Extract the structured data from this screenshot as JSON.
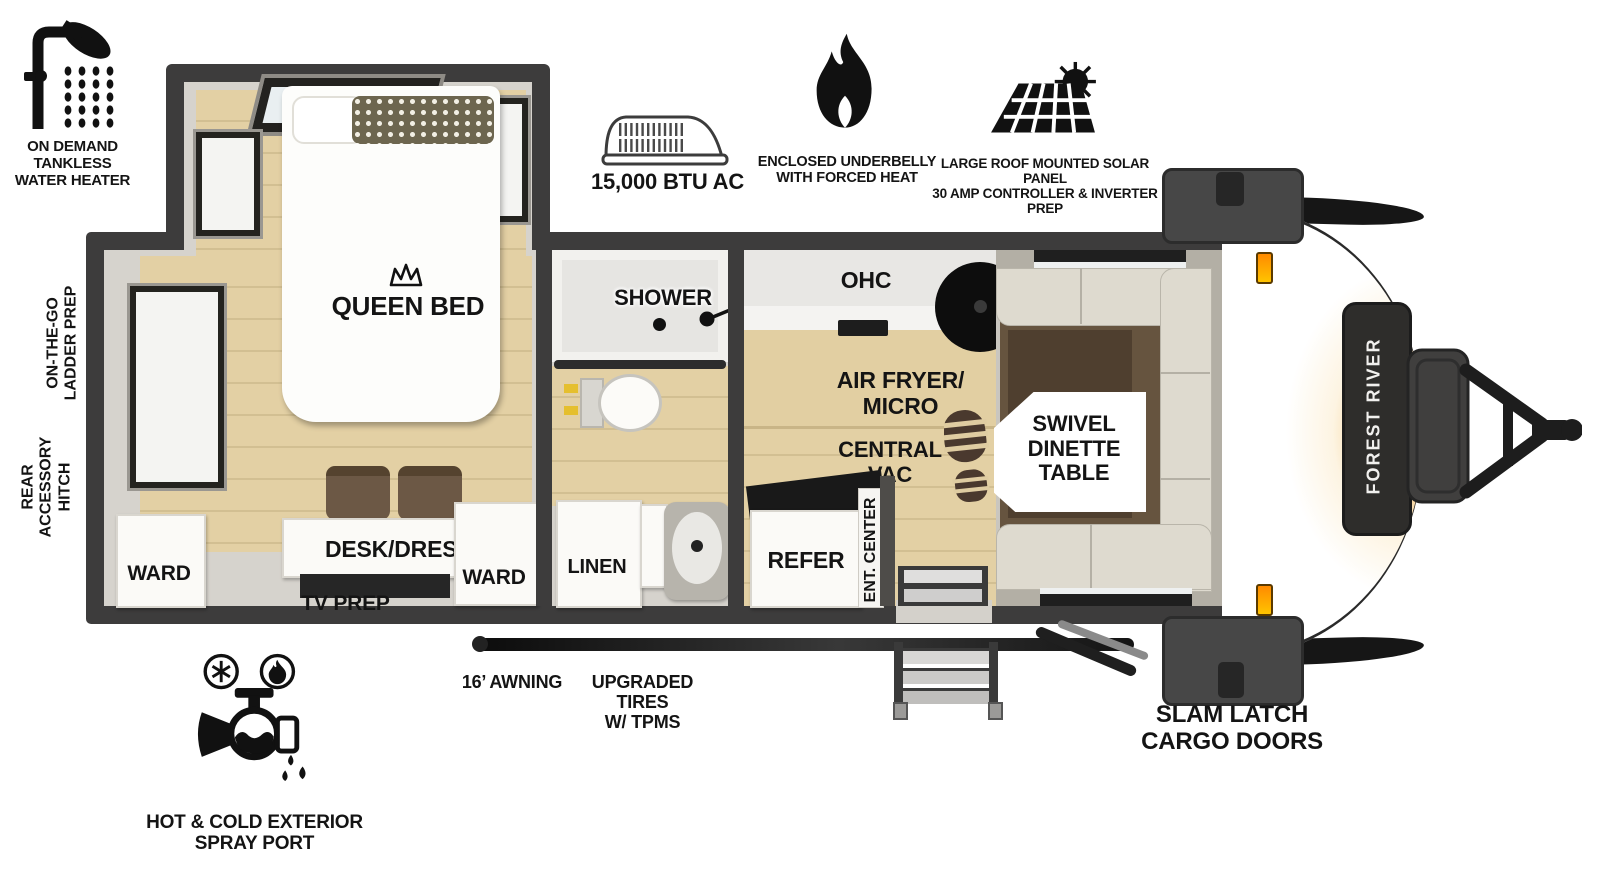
{
  "legend": {
    "water_heater": "ON DEMAND\nTANKLESS\nWATER HEATER",
    "ac": "15,000 BTU AC",
    "underbelly": "ENCLOSED UNDERBELLY\nWITH FORCED HEAT",
    "solar": "LARGE ROOF MOUNTED SOLAR PANEL\n30 AMP CONTROLLER & INVERTER PREP"
  },
  "side_labels": {
    "ladder_prep": "ON-THE-GO\nLADDER PREP",
    "rear_hitch": "REAR\nACCESSORY\nHITCH"
  },
  "rooms": {
    "queen_bed": "QUEEN BED",
    "ward_left": "WARD",
    "ward_right": "WARD",
    "desk_dresser": "DESK/DRESSER",
    "tv_prep": "TV PREP",
    "shower": "SHOWER",
    "linen": "LINEN",
    "ohc": "OHC",
    "air_fryer_micro": "AIR FRYER/\nMICRO",
    "central_vac": "CENTRAL\nVAC",
    "swivel_dinette": "SWIVEL\nDINETTE\nTABLE",
    "refer": "REFER",
    "ent_center": "ENT. CENTER"
  },
  "exterior": {
    "awning": "16’ AWNING",
    "tires": "UPGRADED TIRES\nW/ TPMS",
    "spray_port": "HOT & COLD EXTERIOR\nSPRAY PORT",
    "cargo_doors": "SLAM LATCH\nCARGO DOORS",
    "brand": "FOREST RIVER"
  },
  "colors": {
    "wall": "#3d3c3c",
    "interior": "#d6d3cd",
    "wood_floor": "#e0cda3",
    "accent_orange": "#f5a019"
  }
}
